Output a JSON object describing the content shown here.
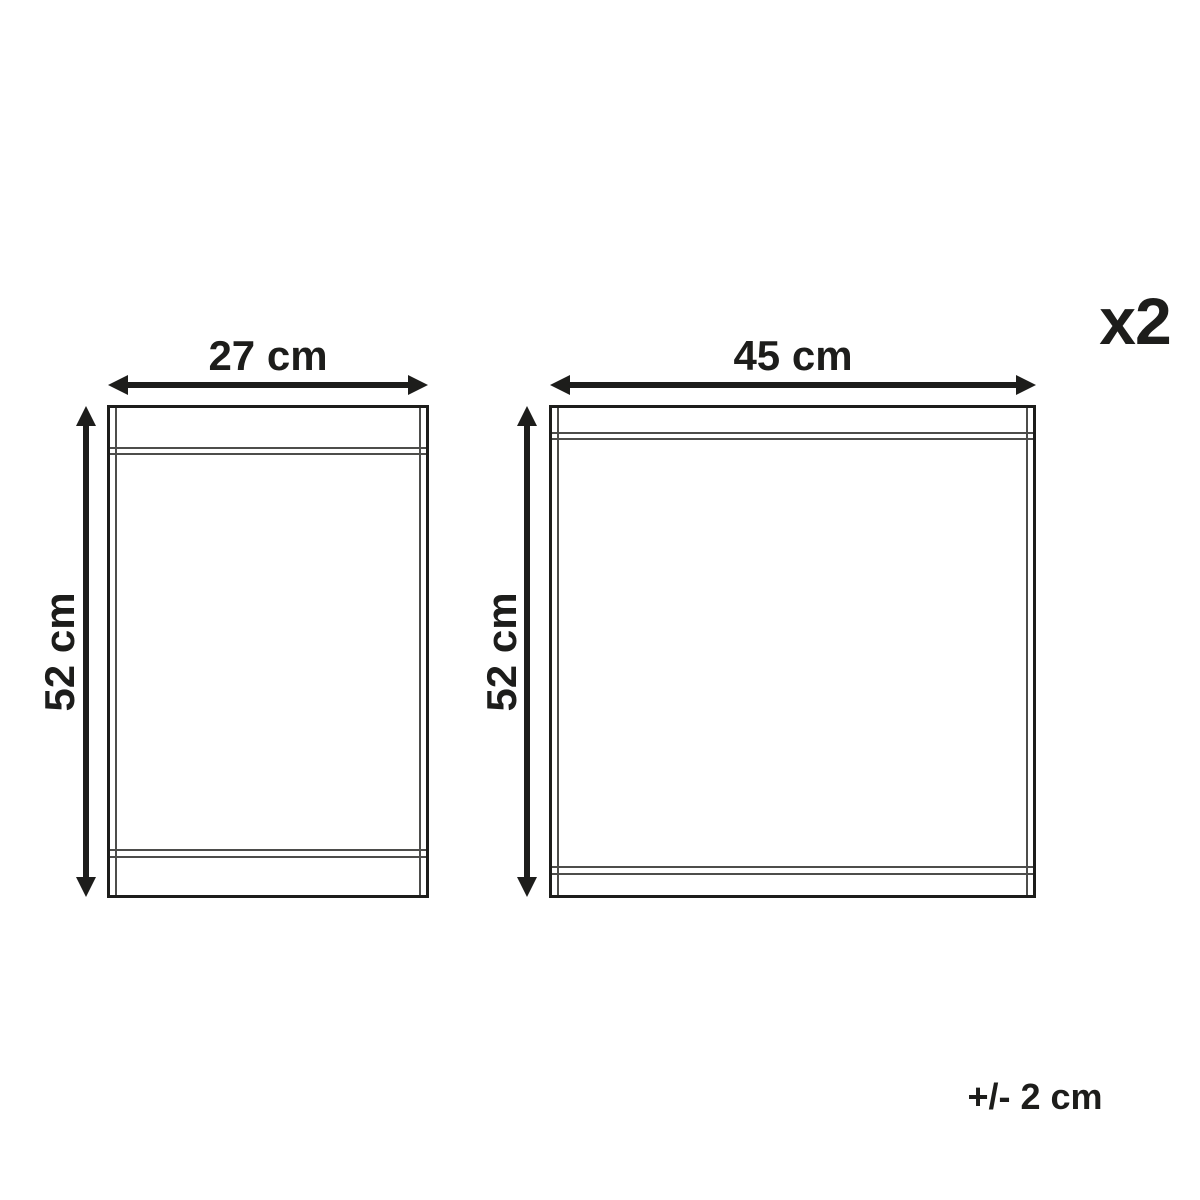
{
  "diagram": {
    "quantity": "x2",
    "tolerance": "+/- 2 cm",
    "panels": [
      {
        "id": "small",
        "width_label": "27 cm",
        "height_label": "52 cm"
      },
      {
        "id": "large",
        "width_label": "45 cm",
        "height_label": "52 cm"
      }
    ],
    "colors": {
      "background": "#ffffff",
      "outline": "#1d1d1b",
      "inner_line": "#4d4d4b",
      "text": "#1d1d1b"
    }
  }
}
